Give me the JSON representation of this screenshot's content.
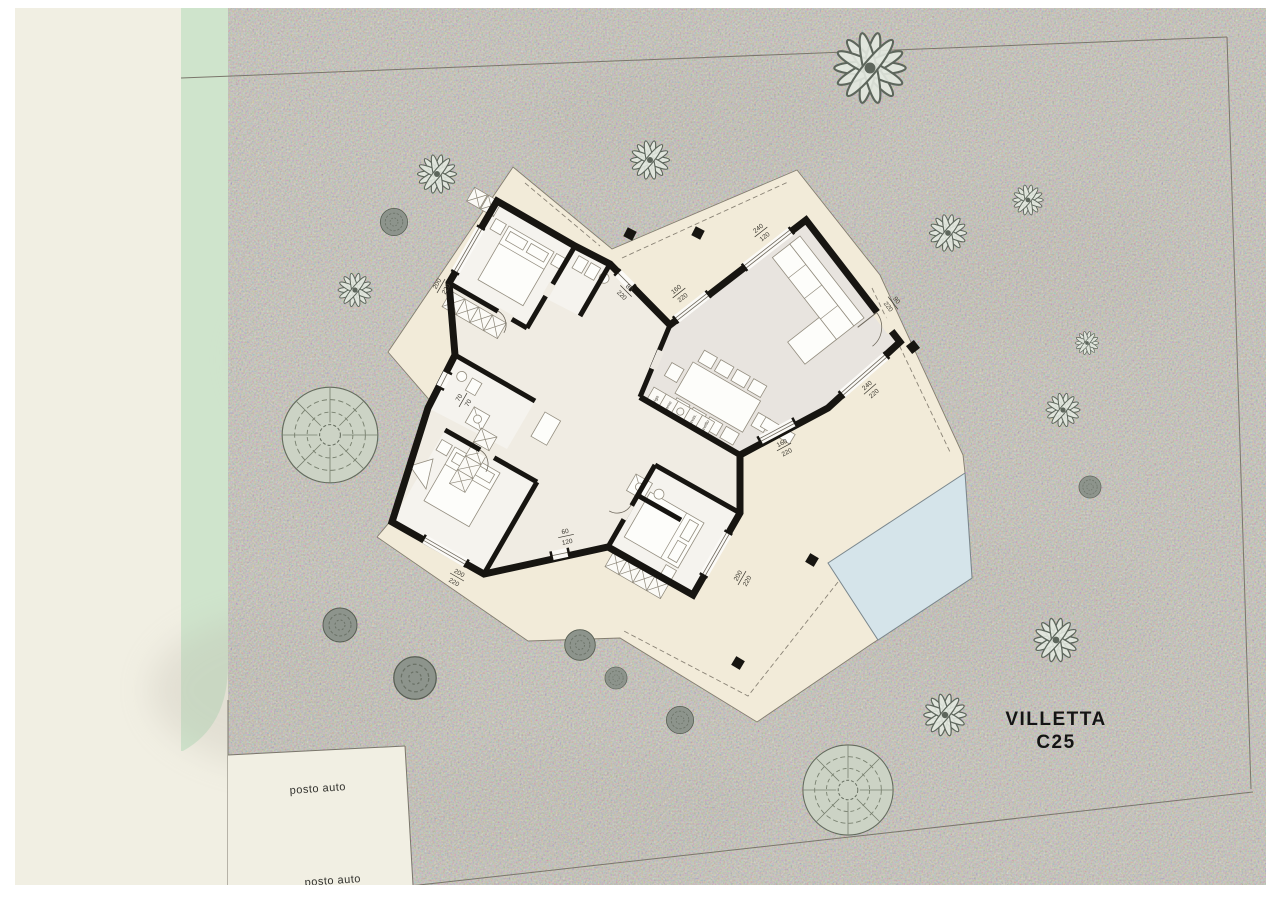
{
  "title": {
    "line1": "VILLETTA",
    "line2": "C25"
  },
  "parking": {
    "label1": "posto auto",
    "label2": "posto auto"
  },
  "kitchen": {
    "items": [
      "frigo",
      "forno",
      "",
      "lavas.",
      "lavello"
    ],
    "tv_label": "tv"
  },
  "dims": [
    {
      "n": "200",
      "d": "220"
    },
    {
      "n": "80",
      "d": "220"
    },
    {
      "n": "160",
      "d": "220"
    },
    {
      "n": "240",
      "d": "120"
    },
    {
      "n": "90",
      "d": "220"
    },
    {
      "n": "240",
      "d": "220"
    },
    {
      "n": "160",
      "d": "220"
    },
    {
      "n": "70",
      "d": "70"
    },
    {
      "n": "60",
      "d": "120"
    },
    {
      "n": "200",
      "d": "220"
    },
    {
      "n": "200",
      "d": "220"
    }
  ],
  "colors": {
    "terrain": "#c9c5ba",
    "road": "#f1efe3",
    "green_strip": "#cfe4cc",
    "terrace": "#f2ebd9",
    "pool": "#d5e4ea",
    "living_floor": "#e8e4df",
    "room_floor": "#f5f3ee",
    "wall": "#171511"
  }
}
